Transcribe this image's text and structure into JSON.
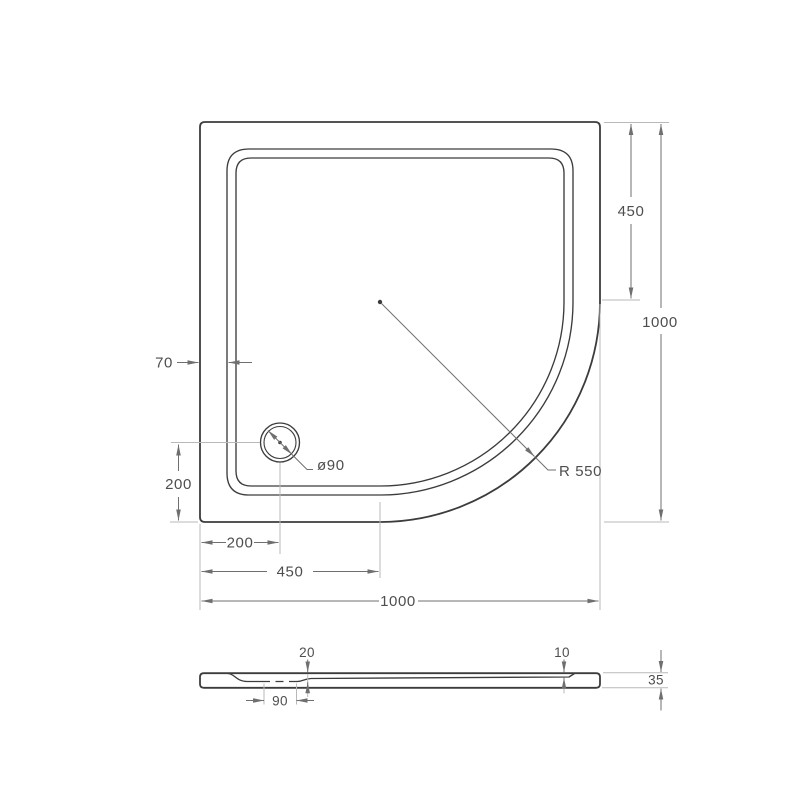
{
  "colors": {
    "background": "#ffffff",
    "outline": "#3c3c3c",
    "dimension_lines": "#6f6f6f",
    "extension_lines": "#b9b9b9",
    "text": "#4e4e4e"
  },
  "top_view": {
    "dim_right_inner": "450",
    "dim_right_overall": "1000",
    "dim_rim_width": "70",
    "dim_drain_from_bottom": "200",
    "dim_drain_from_left": "200",
    "dim_arc_center_from_left": "450",
    "dim_overall_width": "1000",
    "label_drain_diameter": "ø90",
    "label_corner_radius": "R 550"
  },
  "side_view": {
    "dim_basin_depth": "20",
    "dim_edge_depth": "10",
    "dim_drain_recess_width": "90",
    "dim_overall_height": "35"
  }
}
